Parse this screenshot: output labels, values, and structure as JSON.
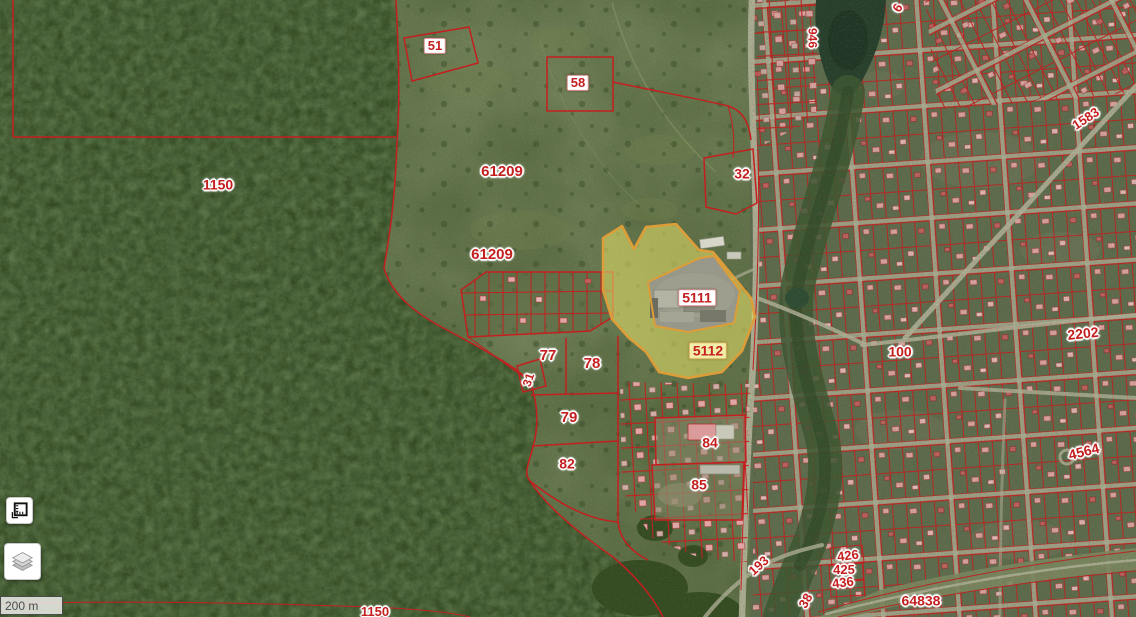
{
  "map": {
    "kind": "cadastral-satellite-map",
    "labels": [
      {
        "text": "51",
        "x": 435,
        "y": 46,
        "style": "box",
        "size": 13
      },
      {
        "text": "58",
        "x": 578,
        "y": 83,
        "style": "box",
        "size": 13
      },
      {
        "text": "61209",
        "x": 502,
        "y": 172,
        "style": "halo",
        "size": 15
      },
      {
        "text": "61209",
        "x": 492,
        "y": 255,
        "style": "halo",
        "size": 15
      },
      {
        "text": "1150",
        "x": 218,
        "y": 185,
        "style": "halo",
        "size": 14
      },
      {
        "text": "32",
        "x": 742,
        "y": 174,
        "style": "halo",
        "size": 14
      },
      {
        "text": "5111",
        "x": 697,
        "y": 298,
        "style": "box",
        "size": 14
      },
      {
        "text": "5112",
        "x": 708,
        "y": 351,
        "style": "box-tinted",
        "size": 14
      },
      {
        "text": "77",
        "x": 548,
        "y": 356,
        "style": "halo",
        "size": 15
      },
      {
        "text": "78",
        "x": 592,
        "y": 364,
        "style": "halo",
        "size": 15
      },
      {
        "text": "31",
        "x": 529,
        "y": 380,
        "style": "halo",
        "size": 12,
        "rot": -72
      },
      {
        "text": "79",
        "x": 569,
        "y": 418,
        "style": "halo",
        "size": 15
      },
      {
        "text": "82",
        "x": 567,
        "y": 464,
        "style": "halo",
        "size": 14
      },
      {
        "text": "84",
        "x": 710,
        "y": 443,
        "style": "halo",
        "size": 14
      },
      {
        "text": "85",
        "x": 699,
        "y": 485,
        "style": "halo",
        "size": 14
      },
      {
        "text": "100",
        "x": 900,
        "y": 352,
        "style": "halo",
        "size": 14
      },
      {
        "text": "2202",
        "x": 1083,
        "y": 334,
        "style": "halo",
        "size": 14,
        "rot": -6
      },
      {
        "text": "4564",
        "x": 1084,
        "y": 452,
        "style": "halo",
        "size": 14,
        "rot": -14
      },
      {
        "text": "1583",
        "x": 1086,
        "y": 119,
        "style": "halo",
        "size": 13,
        "rot": -33
      },
      {
        "text": "946",
        "x": 812,
        "y": 38,
        "style": "halo",
        "size": 12,
        "rot": 90
      },
      {
        "text": "6",
        "x": 898,
        "y": 8,
        "style": "halo",
        "size": 13,
        "rot": -58
      },
      {
        "text": "426",
        "x": 848,
        "y": 556,
        "style": "halo",
        "size": 13,
        "rot": -7
      },
      {
        "text": "425",
        "x": 844,
        "y": 570,
        "style": "halo",
        "size": 13
      },
      {
        "text": "436",
        "x": 843,
        "y": 583,
        "style": "halo",
        "size": 13,
        "rot": -7
      },
      {
        "text": "193",
        "x": 759,
        "y": 566,
        "style": "halo",
        "size": 13,
        "rot": -42
      },
      {
        "text": "38",
        "x": 806,
        "y": 601,
        "style": "halo",
        "size": 13,
        "rot": -60
      },
      {
        "text": "64838",
        "x": 921,
        "y": 601,
        "style": "halo",
        "size": 14
      },
      {
        "text": "1150",
        "x": 375,
        "y": 612,
        "style": "halo",
        "size": 13
      }
    ]
  },
  "controls": {
    "scale_label": "200 m",
    "buttons": [
      {
        "id": "measure",
        "icon": "measure-icon"
      },
      {
        "id": "layers",
        "icon": "layers-icon"
      }
    ]
  },
  "colors": {
    "red": "#c41f1f",
    "hl-fill": "#e9e469",
    "hl-stroke": "#dd9d38",
    "road": "#b6b59c",
    "pink": "#e0a6a6"
  }
}
